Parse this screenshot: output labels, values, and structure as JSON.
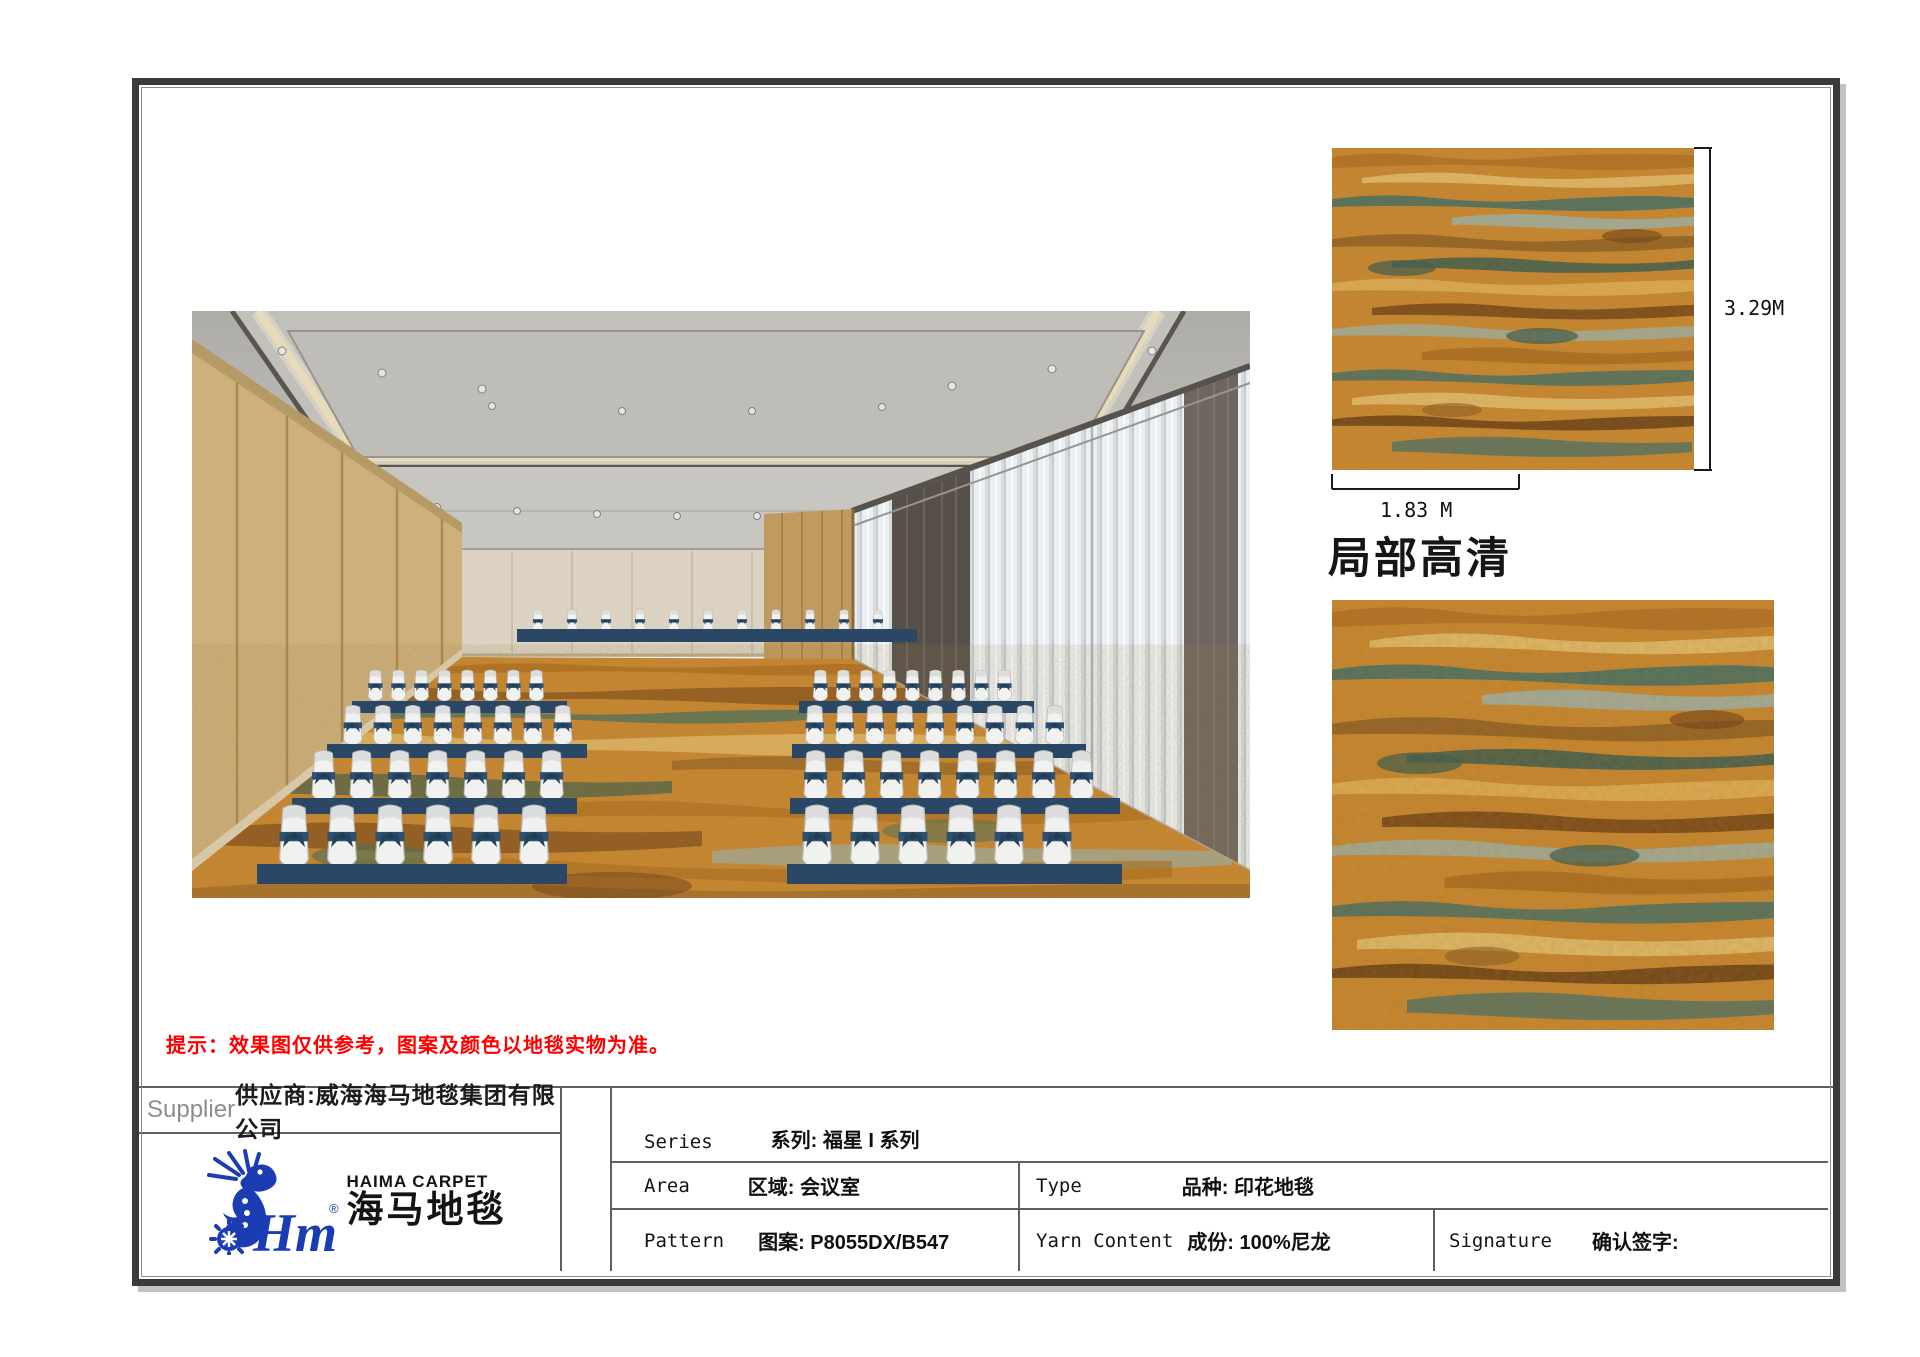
{
  "sheet": {
    "note": "提示：效果图仅供参考，图案及颜色以地毯实物为准。",
    "detail_heading": "局部高清",
    "height_label": "3.29M",
    "width_label": "1.83 M"
  },
  "supplier": {
    "label": "Supplier",
    "name": "供应商:威海海马地毯集团有限公司"
  },
  "brand": {
    "monogram": "Hm",
    "registered": "®",
    "name_en": "HAIMA CARPET",
    "name_zh": "海马地毯",
    "blue": "#1c3cb4"
  },
  "spec": {
    "series_label": "Series",
    "series_value": "系列: 福星 I 系列",
    "area_label": "Area",
    "area_value": "区域: 会议室",
    "pattern_label": "Pattern",
    "pattern_value": "图案: P8055DX/B547",
    "type_label": "Type",
    "type_value": "品种: 印花地毯",
    "yarn_label": "Yarn Content",
    "yarn_value": "成份: 100%尼龙",
    "signature_label": "Signature",
    "signature_value": "确认签字:"
  },
  "palette": {
    "carpet_base": "#c8872e",
    "carpet_teal": "#3d6e62",
    "carpet_brown": "#6b3a10",
    "carpet_tan": "#e3bc6d",
    "table_cloth_navy": "#2b4766",
    "note_red": "#fe0000",
    "logo_blue": "#1c3cb4"
  }
}
